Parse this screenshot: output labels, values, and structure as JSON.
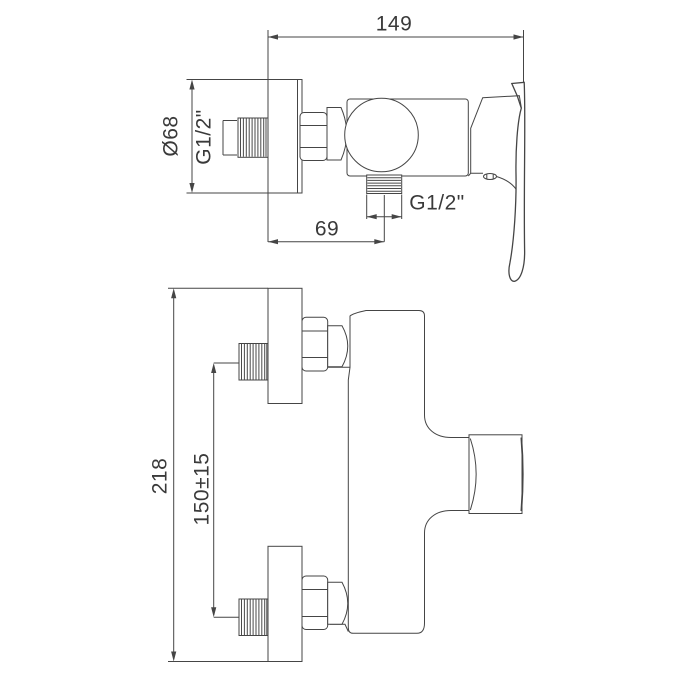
{
  "drawing": {
    "background": "#ffffff",
    "line_color": "#454545",
    "text_color": "#3a3a3a",
    "top_view": {
      "total_depth": "149",
      "escutcheon_diameter": "Ø68",
      "inlet_thread": "G1/2\"",
      "outlet_offset": "69",
      "outlet_thread": "G1/2\""
    },
    "side_view": {
      "total_height": "218",
      "inlet_spacing": "150±15"
    }
  }
}
